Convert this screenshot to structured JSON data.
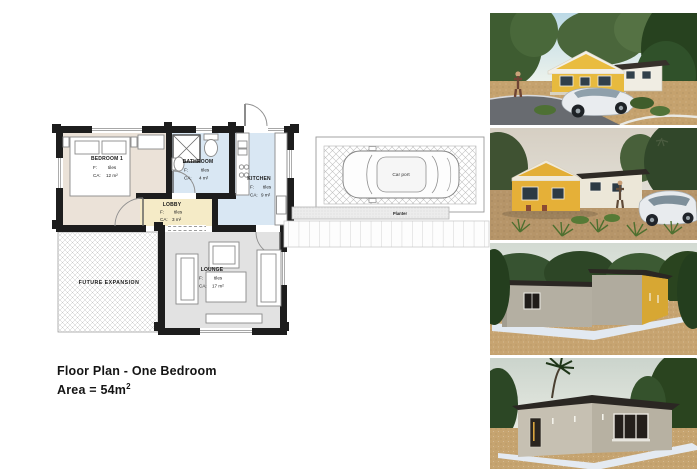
{
  "title": {
    "line1": "Floor Plan - One Bedroom",
    "line2_base": "Area = 54m",
    "line2_sup": "2"
  },
  "plan": {
    "rooms": {
      "bedroom": {
        "name": "BEDROOM 1",
        "f_label": "F:",
        "f_value": "tiles",
        "ca_label": "CA:",
        "ca_value": "12 m²"
      },
      "bathroom": {
        "name": "BATHROOM",
        "f_label": "F:",
        "f_value": "tiles",
        "ca_label": "CA:",
        "ca_value": "4 m²"
      },
      "kitchen": {
        "name": "KITCHEN",
        "f_label": "F:",
        "f_value": "tiles",
        "ca_label": "CA:",
        "ca_value": "9 m²"
      },
      "lobby": {
        "name": "LOBBY",
        "f_label": "F:",
        "f_value": "tiles",
        "ca_label": "CA:",
        "ca_value": "3 m²"
      },
      "lounge": {
        "name": "LOUNGE",
        "f_label": "F:",
        "f_value": "tiles",
        "ca_label": "CA:",
        "ca_value": "17 m²"
      },
      "future_expansion": {
        "name": "FUTURE EXPANSION"
      }
    },
    "carport_label": "Car port",
    "planter_label": "Planter"
  },
  "colors": {
    "wall": "#1d1d1d",
    "bedroom_fill": "#ebe2d8",
    "wet_room_fill": "#d9e7f3",
    "lobby_fill": "#f5ebc7",
    "lounge_fill": "#e2e2e2",
    "accent_yellow": "#e5b33c",
    "roof_dark": "#2b2723",
    "sand_ground": "#c5a26e"
  }
}
